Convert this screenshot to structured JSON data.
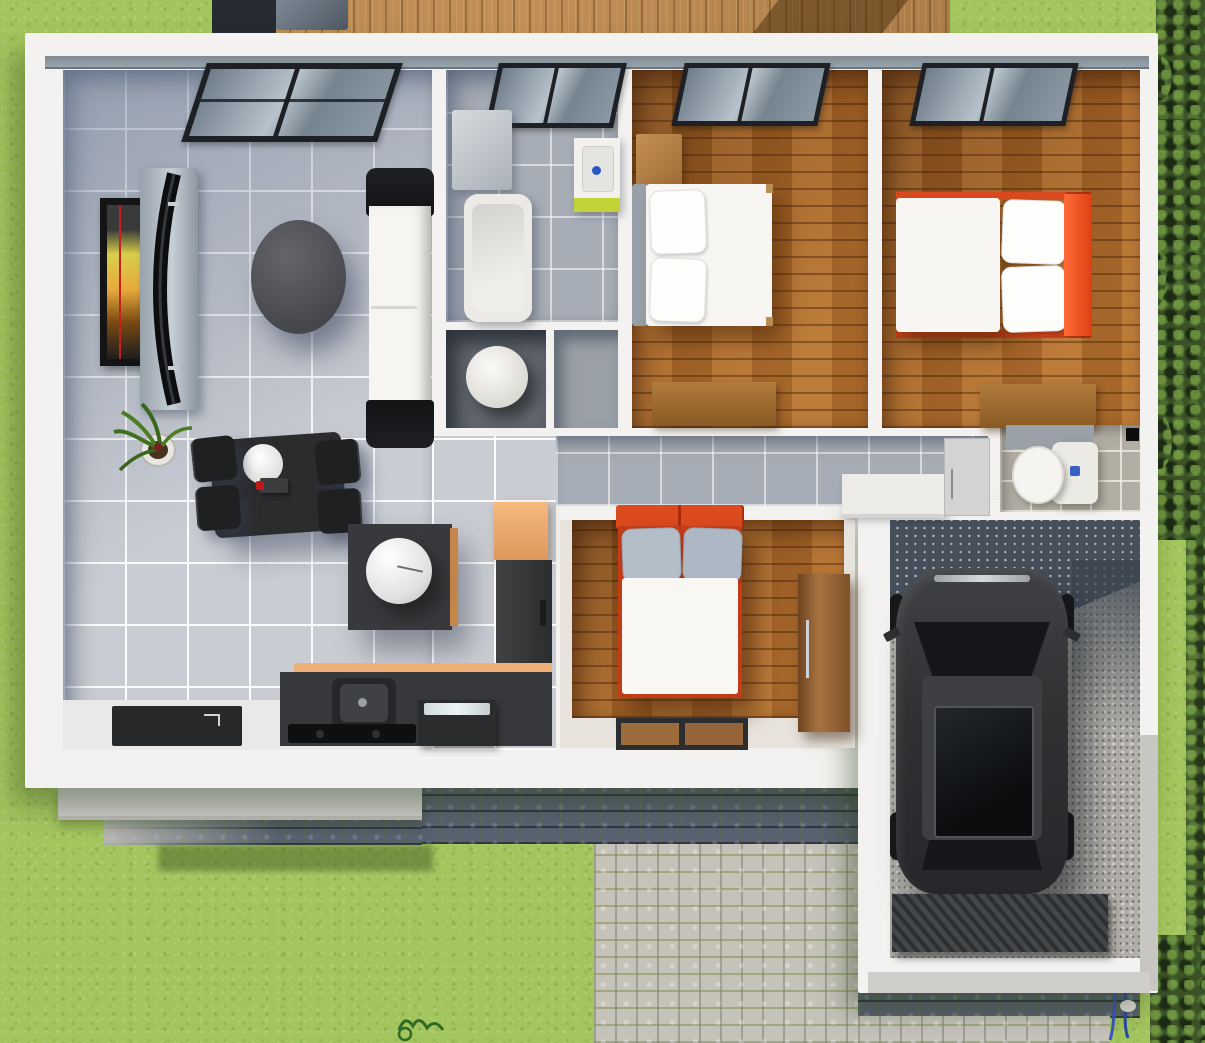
{
  "scene": {
    "type": "3d-floor-plan-render",
    "view": "top-down",
    "description": "Single-story house render with living-dining-kitchen, bathroom, three bedrooms, hallway, toilet room and attached garage with black car; wooden deck at top, lawn around, cobblestone driveway at bottom, hedge along right edge",
    "text_visible": "none"
  },
  "palette": {
    "grass": "#a3c55e",
    "deck_wood": "#b3854f",
    "floor_wood": "#a26226",
    "tile_living": "#c9ccd2",
    "tile_bath": "#a7adb6",
    "tile_toilet": "#b2aea4",
    "wall_white": "#f3f2f0",
    "accent_orange_bed": "#dd4a1f",
    "accent_orange_kitchen": "#eeb077",
    "accent_lime_vanity": "#c3d337",
    "cobble_light": "#c5c2ba",
    "cobble_dark": "#57616f",
    "garage_gravel": "#b2afa9",
    "car_black": "#2f3133",
    "hedge_green": "#3a5226",
    "window_frame": "#1d2126"
  },
  "rooms": [
    {
      "name": "living-dining-kitchen",
      "floor": "gray ceramic tile",
      "furniture": [
        "patio sliding door",
        "framed picture",
        "curved wall tv on panel",
        "oval coffee table",
        "white sofa with black arms",
        "potted plant",
        "dining table with white plate and four black chairs",
        "side table with sphere lamp",
        "pantry cabinet",
        "fridge",
        "kitchen counter with sink",
        "oven",
        "black cooktop",
        "entrance door mat"
      ]
    },
    {
      "name": "bathroom",
      "floor": "blue-gray tile",
      "furniture": [
        "window",
        "storage cabinet",
        "bathtub",
        "vanity sink with lime cabinet and blue faucet"
      ]
    },
    {
      "name": "utility-nook",
      "furniture": [
        "white cylinder water heater"
      ]
    },
    {
      "name": "closet",
      "furniture": []
    },
    {
      "name": "bedroom-1",
      "floor": "wood planks",
      "furniture": [
        "window",
        "nightstand",
        "double bed with white duvet and two pillows",
        "wooden dresser"
      ]
    },
    {
      "name": "bedroom-2",
      "floor": "wood planks",
      "furniture": [
        "window",
        "double bed with orange headboard and white duvet",
        "wooden dresser"
      ]
    },
    {
      "name": "hallway",
      "floor": "gray tile",
      "furniture": [
        "white counter",
        "cabinet"
      ]
    },
    {
      "name": "toilet-room",
      "floor": "beige tile",
      "furniture": [
        "toilet with cistern",
        "partition wall"
      ]
    },
    {
      "name": "bedroom-3",
      "floor": "wood planks with cream border",
      "furniture": [
        "double bed with orange frame and gray pillows",
        "tall wooden wardrobe",
        "two-panel door mat"
      ]
    },
    {
      "name": "garage",
      "floor": "speckled gravel",
      "furniture": [
        "black car with sunroof and side mirrors",
        "ribbed entrance ramp"
      ]
    }
  ],
  "environment": [
    "wooden deck with dark outdoor furniture",
    "lawn",
    "hedge along right edge",
    "cobblestone driveway",
    "shadow cobblestone strip",
    "porch step",
    "small blue plant",
    "grass sprig"
  ]
}
